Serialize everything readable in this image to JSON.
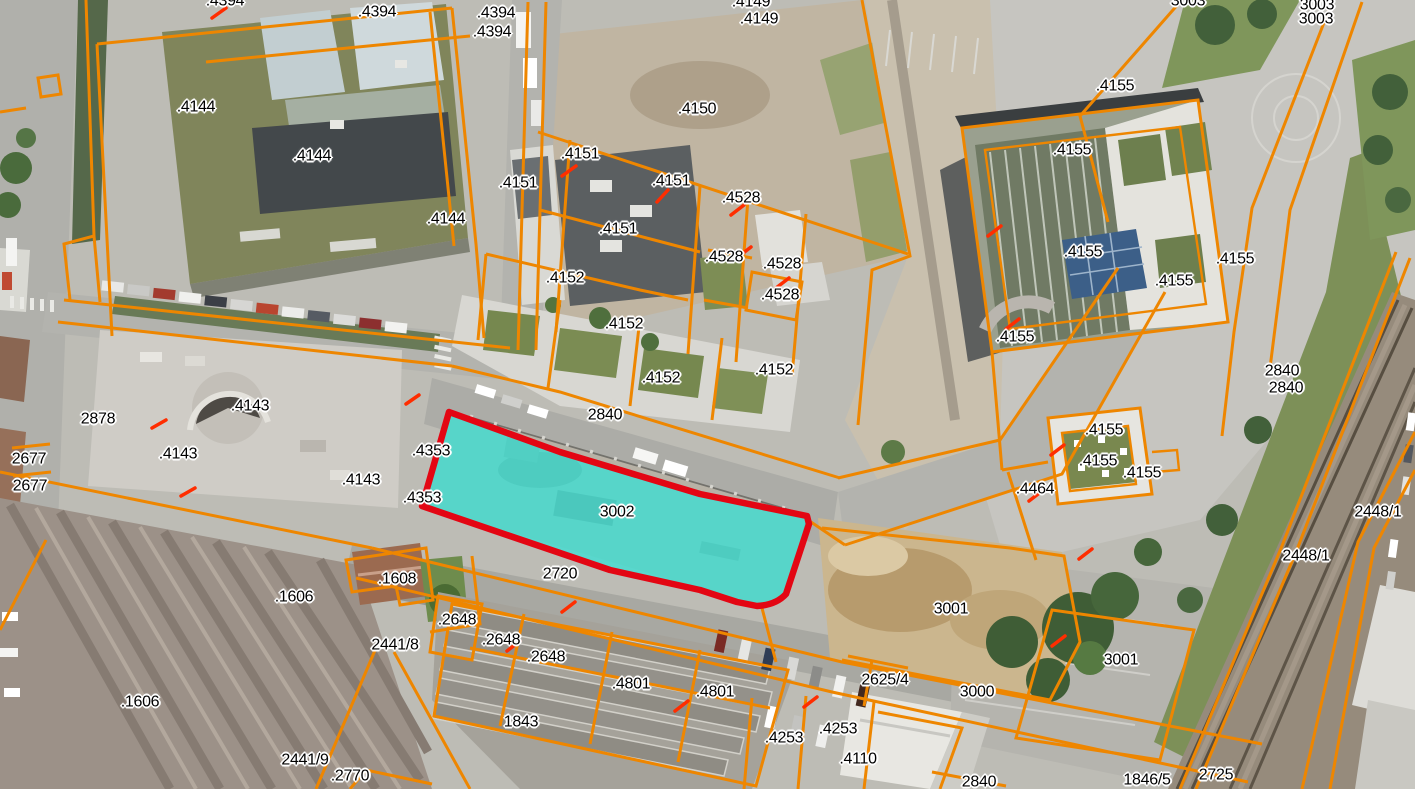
{
  "map": {
    "boundary_color": "#EE8600",
    "tick_color": "#FF2D00",
    "label_text_color": "#000000",
    "label_halo_color": "#FFFFFF",
    "highlighted_parcel": {
      "number": "3002",
      "fill": "#3CDFD4",
      "stroke": "#E30613",
      "label_x": 617,
      "label_y": 513
    },
    "parcel_labels": [
      {
        "text": ".4394",
        "x": 225,
        "y": 2
      },
      {
        "text": ".4394",
        "x": 377,
        "y": 13
      },
      {
        "text": ".4394",
        "x": 496,
        "y": 14
      },
      {
        "text": ".4394",
        "x": 492,
        "y": 33
      },
      {
        "text": ".4144",
        "x": 196,
        "y": 108
      },
      {
        "text": ".4144",
        "x": 312,
        "y": 157
      },
      {
        "text": ".4144",
        "x": 446,
        "y": 220
      },
      {
        "text": ".4149",
        "x": 751,
        "y": 3
      },
      {
        "text": ".4149",
        "x": 759,
        "y": 20
      },
      {
        "text": ".4150",
        "x": 697,
        "y": 110
      },
      {
        "text": ".4151",
        "x": 518,
        "y": 184
      },
      {
        "text": ".4151",
        "x": 580,
        "y": 155
      },
      {
        "text": ".4151",
        "x": 671,
        "y": 182
      },
      {
        "text": ".4151",
        "x": 618,
        "y": 230
      },
      {
        "text": ".4528",
        "x": 741,
        "y": 199
      },
      {
        "text": ".4528",
        "x": 724,
        "y": 258
      },
      {
        "text": ".4528",
        "x": 782,
        "y": 265
      },
      {
        "text": ".4528",
        "x": 780,
        "y": 296
      },
      {
        "text": ".4152",
        "x": 565,
        "y": 279
      },
      {
        "text": ".4152",
        "x": 624,
        "y": 325
      },
      {
        "text": ".4152",
        "x": 661,
        "y": 379
      },
      {
        "text": ".4152",
        "x": 774,
        "y": 371
      },
      {
        "text": "3003",
        "x": 1188,
        "y": 2
      },
      {
        "text": "3003",
        "x": 1317,
        "y": 6
      },
      {
        "text": "3003",
        "x": 1316,
        "y": 20
      },
      {
        "text": ".4155",
        "x": 1115,
        "y": 87
      },
      {
        "text": ".4155",
        "x": 1072,
        "y": 151
      },
      {
        "text": ".4155",
        "x": 1083,
        "y": 253
      },
      {
        "text": ".4155",
        "x": 1235,
        "y": 260
      },
      {
        "text": ".4155",
        "x": 1174,
        "y": 282
      },
      {
        "text": ".4155",
        "x": 1015,
        "y": 338
      },
      {
        "text": ".4155",
        "x": 1104,
        "y": 431
      },
      {
        "text": ".4155",
        "x": 1098,
        "y": 462
      },
      {
        "text": ".4155",
        "x": 1142,
        "y": 474
      },
      {
        "text": ".4464",
        "x": 1035,
        "y": 490
      },
      {
        "text": "2840",
        "x": 1282,
        "y": 372
      },
      {
        "text": "2840",
        "x": 1286,
        "y": 389
      },
      {
        "text": "2448/1",
        "x": 1378,
        "y": 513
      },
      {
        "text": "2448/1",
        "x": 1306,
        "y": 557
      },
      {
        "text": "2878",
        "x": 98,
        "y": 420
      },
      {
        "text": ".4143",
        "x": 250,
        "y": 407
      },
      {
        "text": ".4143",
        "x": 178,
        "y": 455
      },
      {
        "text": ".4143",
        "x": 361,
        "y": 481
      },
      {
        "text": "2677",
        "x": 29,
        "y": 460
      },
      {
        "text": "2677",
        "x": 30,
        "y": 487
      },
      {
        "text": ".4353",
        "x": 431,
        "y": 452
      },
      {
        "text": ".4353",
        "x": 422,
        "y": 499
      },
      {
        "text": "2840",
        "x": 605,
        "y": 416
      },
      {
        "text": "2720",
        "x": 560,
        "y": 575
      },
      {
        "text": ".1608",
        "x": 397,
        "y": 580
      },
      {
        "text": ".1606",
        "x": 294,
        "y": 598
      },
      {
        "text": ".1606",
        "x": 140,
        "y": 703
      },
      {
        "text": "2441/8",
        "x": 395,
        "y": 646
      },
      {
        "text": "2441/9",
        "x": 305,
        "y": 761
      },
      {
        "text": ".2770",
        "x": 350,
        "y": 777
      },
      {
        "text": ".2648",
        "x": 457,
        "y": 621
      },
      {
        "text": ".2648",
        "x": 501,
        "y": 641
      },
      {
        "text": ".2648",
        "x": 546,
        "y": 658
      },
      {
        "text": ".4801",
        "x": 631,
        "y": 685
      },
      {
        "text": ".4801",
        "x": 715,
        "y": 693
      },
      {
        "text": "1843",
        "x": 521,
        "y": 723
      },
      {
        "text": ".4253",
        "x": 784,
        "y": 739
      },
      {
        "text": ".4253",
        "x": 838,
        "y": 730
      },
      {
        "text": ".4110",
        "x": 858,
        "y": 760
      },
      {
        "text": "3001",
        "x": 951,
        "y": 610
      },
      {
        "text": "3001",
        "x": 1121,
        "y": 661
      },
      {
        "text": "2625/4",
        "x": 885,
        "y": 681
      },
      {
        "text": "3000",
        "x": 977,
        "y": 693
      },
      {
        "text": "2840",
        "x": 979,
        "y": 783
      },
      {
        "text": "1846/5",
        "x": 1147,
        "y": 781
      },
      {
        "text": "2725",
        "x": 1216,
        "y": 776
      }
    ]
  }
}
